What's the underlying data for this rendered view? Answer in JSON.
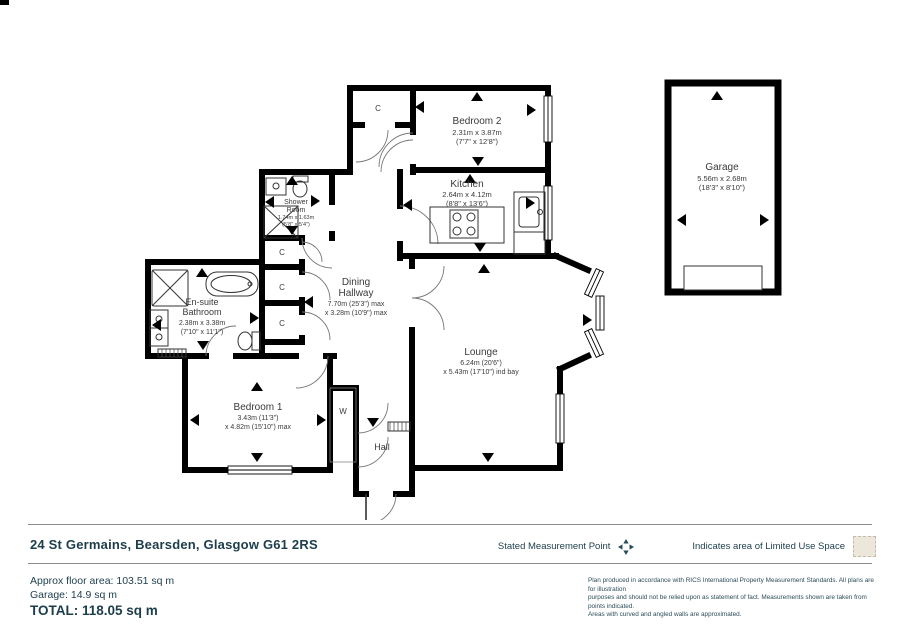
{
  "plan": {
    "rooms": {
      "bedroom2": {
        "name": "Bedroom 2",
        "dims1": "2.31m x 3.87m",
        "dims2": "(7'7\" x 12'8\")"
      },
      "kitchen": {
        "name": "Kitchen",
        "dims1": "2.64m x 4.12m",
        "dims2": "(8'8\" x 13'6\")"
      },
      "shower": {
        "name1": "Shower",
        "name2": "Room",
        "dims1": "1.74m x 1.63m",
        "dims2": "(5'8\" x 5'4\")"
      },
      "ensuite": {
        "name1": "En-suite",
        "name2": "Bathroom",
        "dims1": "2.38m x 3.38m",
        "dims2": "(7'10\" x 11'1\")"
      },
      "dining": {
        "name1": "Dining",
        "name2": "Hallway",
        "dims1": "7.70m (25'3\") max",
        "dims2": "x 3.28m (10'9\") max"
      },
      "lounge": {
        "name": "Lounge",
        "dims1": "6.24m (20'6\")",
        "dims2": "x 5.43m (17'10\") ind bay"
      },
      "bedroom1": {
        "name": "Bedroom 1",
        "dims1": "3.43m (11'3\")",
        "dims2": "x 4.82m (15'10\") max"
      },
      "hall": {
        "name": "Hall"
      },
      "garage": {
        "name": "Garage",
        "dims1": "5.56m x 2.68m",
        "dims2": "(18'3\" x 8'10\")"
      }
    },
    "cupboard_label": "C",
    "wardrobe_label": "W"
  },
  "footer": {
    "address": "24 St Germains, Bearsden, Glasgow G61 2RS",
    "legend": {
      "measurement_point": "Stated Measurement Point",
      "limited_use": "Indicates area of  Limited Use Space",
      "icons": {
        "measurement_point": "four-way-arrow-icon",
        "limited_use": "shaded-square-swatch"
      }
    },
    "areas": {
      "floor": "Approx floor area: 103.51 sq m",
      "garage": "Garage: 14.9 sq m",
      "total": "TOTAL: 118.05 sq m"
    },
    "disclaimer_lines": [
      "Plan produced  in accordance with RICS International Property  Measurement Standards.  All plans are for illustration",
      "purposes and  should not be relied upon as statement of fact.  Measurements shown are taken from points indicated.",
      "Areas with curved and angled walls are approximated."
    ]
  },
  "colors": {
    "wall": "#000000",
    "footer_text": "#1e3d4b",
    "limited_use_swatch": "#ece7da"
  }
}
